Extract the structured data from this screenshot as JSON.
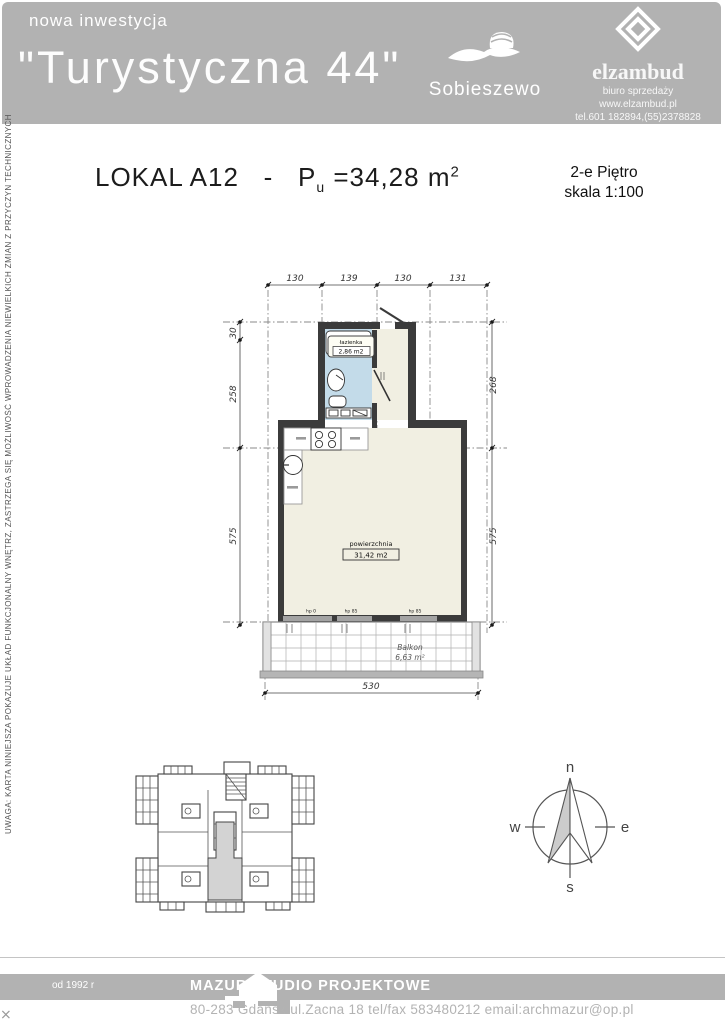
{
  "header": {
    "tagline": "nowa inwestycja",
    "title": "\"Turystyczna 44\"",
    "resort": "Sobieszewo",
    "company": {
      "name": "elzambud",
      "dept": "biuro sprzedaży",
      "www": "www.elzambud.pl",
      "phone": "tel.601 182894,(55)2378828"
    }
  },
  "title_block": {
    "unit": "LOKAL A12",
    "dash": "-",
    "p": "P",
    "p_sub": "u",
    "area": "=34,28 m",
    "area_sup": "2",
    "floor": "2-e Piętro",
    "scale": "skala 1:100"
  },
  "side_note": "UWAGA: KARTA NINIEJSZA  POKAZUJE UKŁAD FUNKCJONALNY WNĘTRZ, ZASTRZEGA SIĘ MOŻLIWOŚĆ WPROWADZENIA NIEWIELKICH ZMIAN Z PRZYCZYN TECHNICZNYCH",
  "plan": {
    "dims_top": [
      "130",
      "139",
      "130",
      "131"
    ],
    "dims_left": [
      "30",
      "258",
      "575"
    ],
    "dims_right": [
      "268",
      "575"
    ],
    "dim_bottom": "530",
    "bathroom_name": "łazienka",
    "bathroom_area": "2,86 m2",
    "room_name": "powierzchnia",
    "room_area": "31,42 m2",
    "balcony_name": "Balkon",
    "balcony_area": "6,63 m²",
    "sill_labels": [
      "hp 0",
      "hp 85",
      "hp 85"
    ]
  },
  "compass": {
    "n": "n",
    "e": "e",
    "s": "s",
    "w": "w"
  },
  "footer": {
    "since": "od 1992 r",
    "studio": "MAZUR STUDIO PROJEKTOWE",
    "address": "80-283 Gdańsk ul.Zacna 18  tel/fax 583480212  email:archmazur@op.pl"
  },
  "colors": {
    "header_gray": "#b2b2b2",
    "plan_cream": "#f1efe2",
    "bathroom_blue": "#c3dbe9",
    "highlight_gray": "#d3d3d3"
  }
}
